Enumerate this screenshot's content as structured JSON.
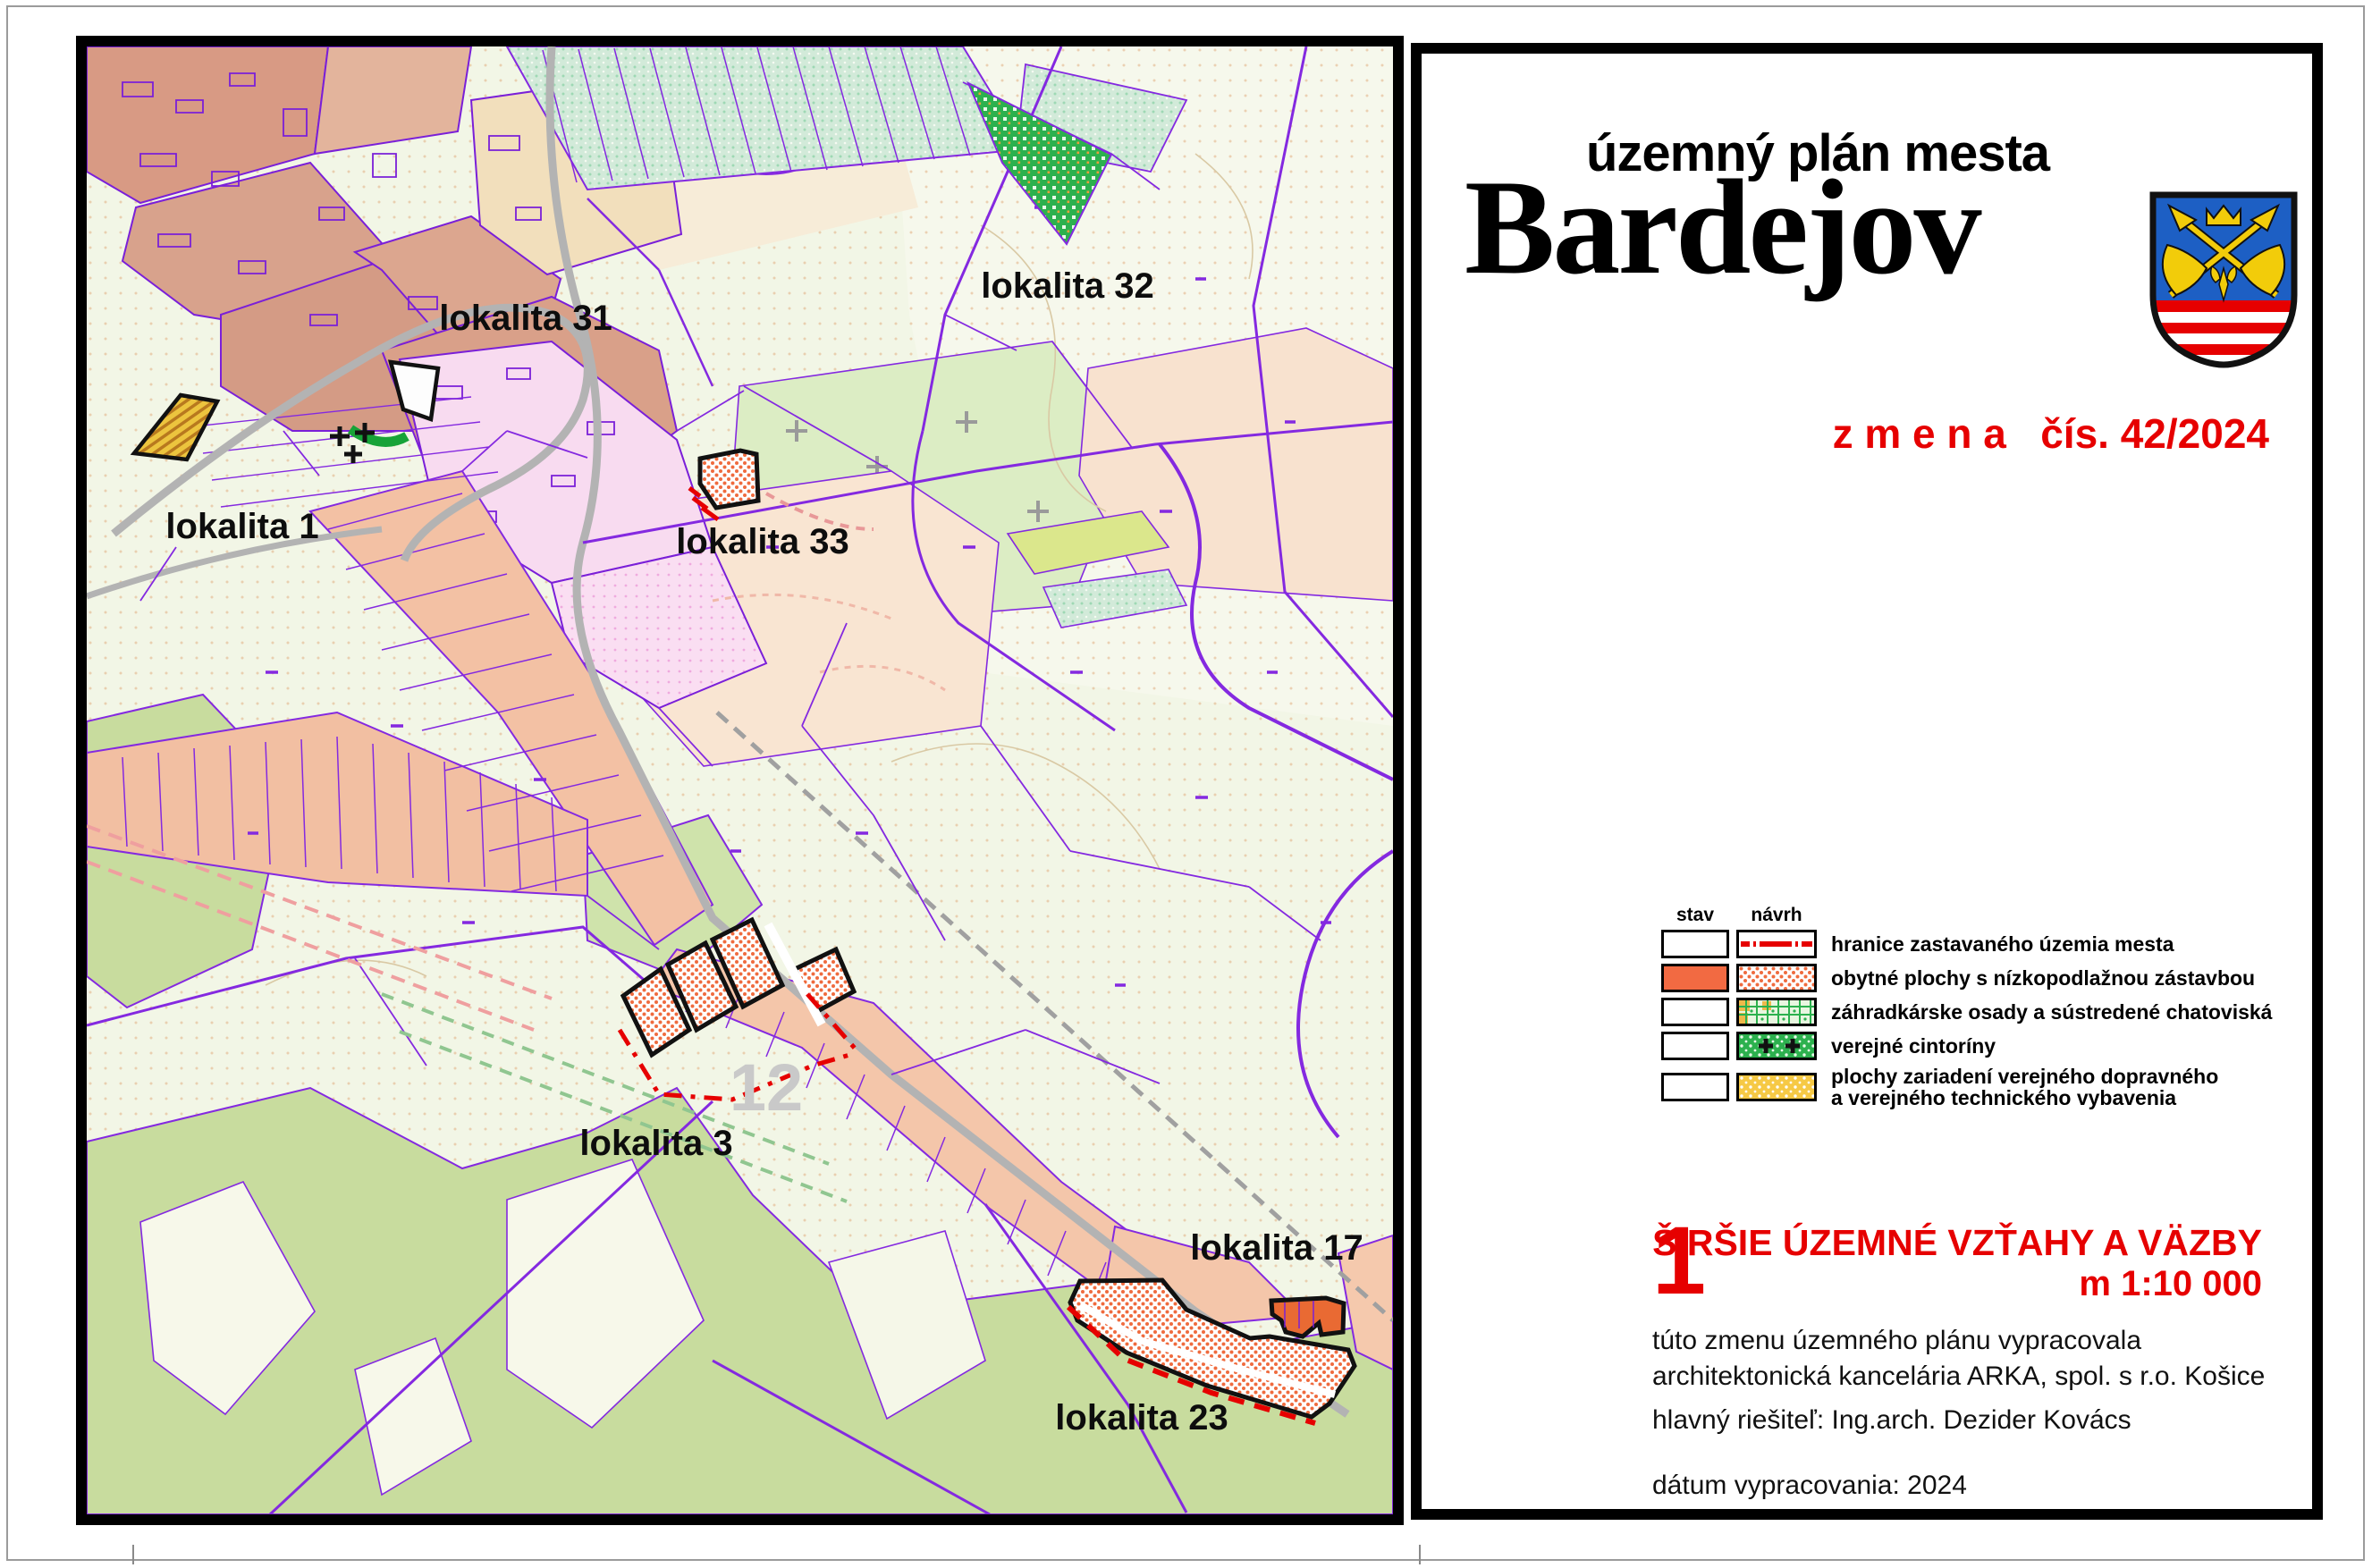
{
  "title_block": {
    "subtitle": "územný plán mesta",
    "city": "Bardejov",
    "change_label": "z m e n a   čís. 42/2024",
    "sheet_number": "1",
    "sheet_title": "ŠIRŠIE ÚZEMNÉ VZŤAHY A VÄZBY",
    "scale": "m 1:10 000",
    "prepared_line1": "túto zmenu územného plánu vypracovala",
    "prepared_line2": "architektonická kancelária ARKA, spol. s r.o. Košice",
    "chief_designer": "hlavný riešiteľ: Ing.arch. Dezider Kovács",
    "date": "dátum vypracovania: 2024"
  },
  "legend": {
    "columns": [
      "stav",
      "návrh"
    ],
    "items": [
      {
        "label": "hranice zastavaného územia mesta",
        "swatch": "red-dash-dot-line"
      },
      {
        "label": "obytné plochy s nízkopodlažnou zástavbou",
        "swatch": "orange-dots"
      },
      {
        "label": "záhradkárske osady a sústredené chatoviská",
        "swatch": "green-garden-grid"
      },
      {
        "label": "verejné cintoríny",
        "swatch": "green-plus"
      },
      {
        "label": "plochy zariadení verejného dopravného",
        "label2": "a verejného technického vybavenia",
        "swatch": "amber-dots"
      }
    ]
  },
  "map": {
    "labels": [
      {
        "text": "lokalita 31"
      },
      {
        "text": "lokalita 32"
      },
      {
        "text": "lokalita 1"
      },
      {
        "text": "lokalita 33"
      },
      {
        "text": "lokalita 3"
      },
      {
        "text": "lokalita 17"
      },
      {
        "text": "lokalita 23"
      }
    ],
    "watermark": "12"
  },
  "colors": {
    "accent_red": "#e60000",
    "map_line_purple": "#8429e0",
    "locality_orange": "#f26a42",
    "forest_green": "#c8dc9e",
    "cemetery_green": "#17a338",
    "coat_blue": "#1d5fc4",
    "coat_yellow": "#f2cc0a"
  }
}
